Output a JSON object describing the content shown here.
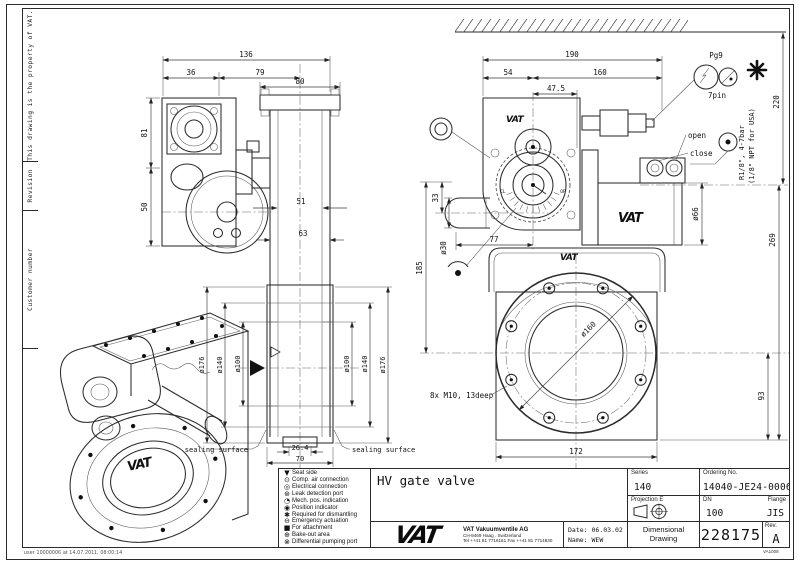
{
  "page": {
    "print_stamp": "user 10000006 at 14.07.2011, 08:00:14",
    "form_code": "VA1008"
  },
  "sidebar": {
    "property_note": "This drawing is the property of VAT.",
    "revision": "Revision",
    "customer_number": "Customer number"
  },
  "legend": {
    "items": [
      {
        "icon": "▼",
        "label": "Seat side"
      },
      {
        "icon": "⊙",
        "label": "Comp. air connection"
      },
      {
        "icon": "◎",
        "label": "Electrical connection"
      },
      {
        "icon": "⊛",
        "label": "Leak detection port"
      },
      {
        "icon": "◔",
        "label": "Mech. pos. indication"
      },
      {
        "icon": "◉",
        "label": "Position indicator"
      },
      {
        "icon": "✱",
        "label": "Required for dismantling"
      },
      {
        "icon": "⊖",
        "label": "Emergency actuation"
      },
      {
        "icon": "■",
        "label": "For attachment"
      },
      {
        "icon": "⊕",
        "label": "Bake-out area"
      },
      {
        "icon": "⊗",
        "label": "Differential pumping port"
      }
    ]
  },
  "title_block": {
    "title": "HV gate valve",
    "series_label": "Series",
    "series": "140",
    "ordering_label": "Ordering No.",
    "ordering_no": "14040-JE24-0006",
    "projection_label": "Projection E",
    "dn_label": "DN",
    "dn": "100",
    "flange_label": "Flange",
    "flange": "JIS",
    "doc_type_line1": "Dimensional",
    "doc_type_line2": "Drawing",
    "drawing_no": "228175",
    "rev_label": "Rev.",
    "rev": "A",
    "logo": "VAT",
    "company_name": "VAT Vakuumventile AG",
    "company_address": "CH-9469 Haag . Switzerland",
    "company_phone": "Tel ++41 81 7716161 Fax ++41 81 7714830",
    "date_label": "Date:",
    "date": "06.03.02",
    "name_label": "Name:",
    "name": "WEW"
  },
  "drawing": {
    "logo_marks": "VAT",
    "front_view": {
      "dim_136": "136",
      "dim_36": "36",
      "dim_79": "79",
      "dim_80": "80",
      "dim_81": "81",
      "dim_50": "50",
      "dim_51": "51",
      "dim_63": "63",
      "dia_176": "ø176",
      "dia_140": "ø140",
      "dia_100": "ø100",
      "dim_26_4": "26.4",
      "dim_70": "70",
      "sealing_surface": "sealing surface"
    },
    "side_view": {
      "dim_190": "190",
      "dim_54": "54",
      "dim_160": "160",
      "dim_47_5": "47.5",
      "dim_220": "220",
      "dim_33": "33",
      "dia_30": "ø30",
      "dim_77": "77",
      "dim_185": "185",
      "dia_66": "ø66",
      "dim_269": "269",
      "dim_93": "93",
      "dim_172": "172",
      "dia_160": "ø160",
      "bolt_note": "8x M10, 13deep",
      "pg9": "Pg9",
      "pin7": "7pin",
      "open": "open",
      "close": "close",
      "air_spec_line1": "R1/8\", 4-7bar",
      "air_spec_line2": "(1/8\" NPT for USA)",
      "cl": "CL",
      "op": "OP"
    }
  }
}
